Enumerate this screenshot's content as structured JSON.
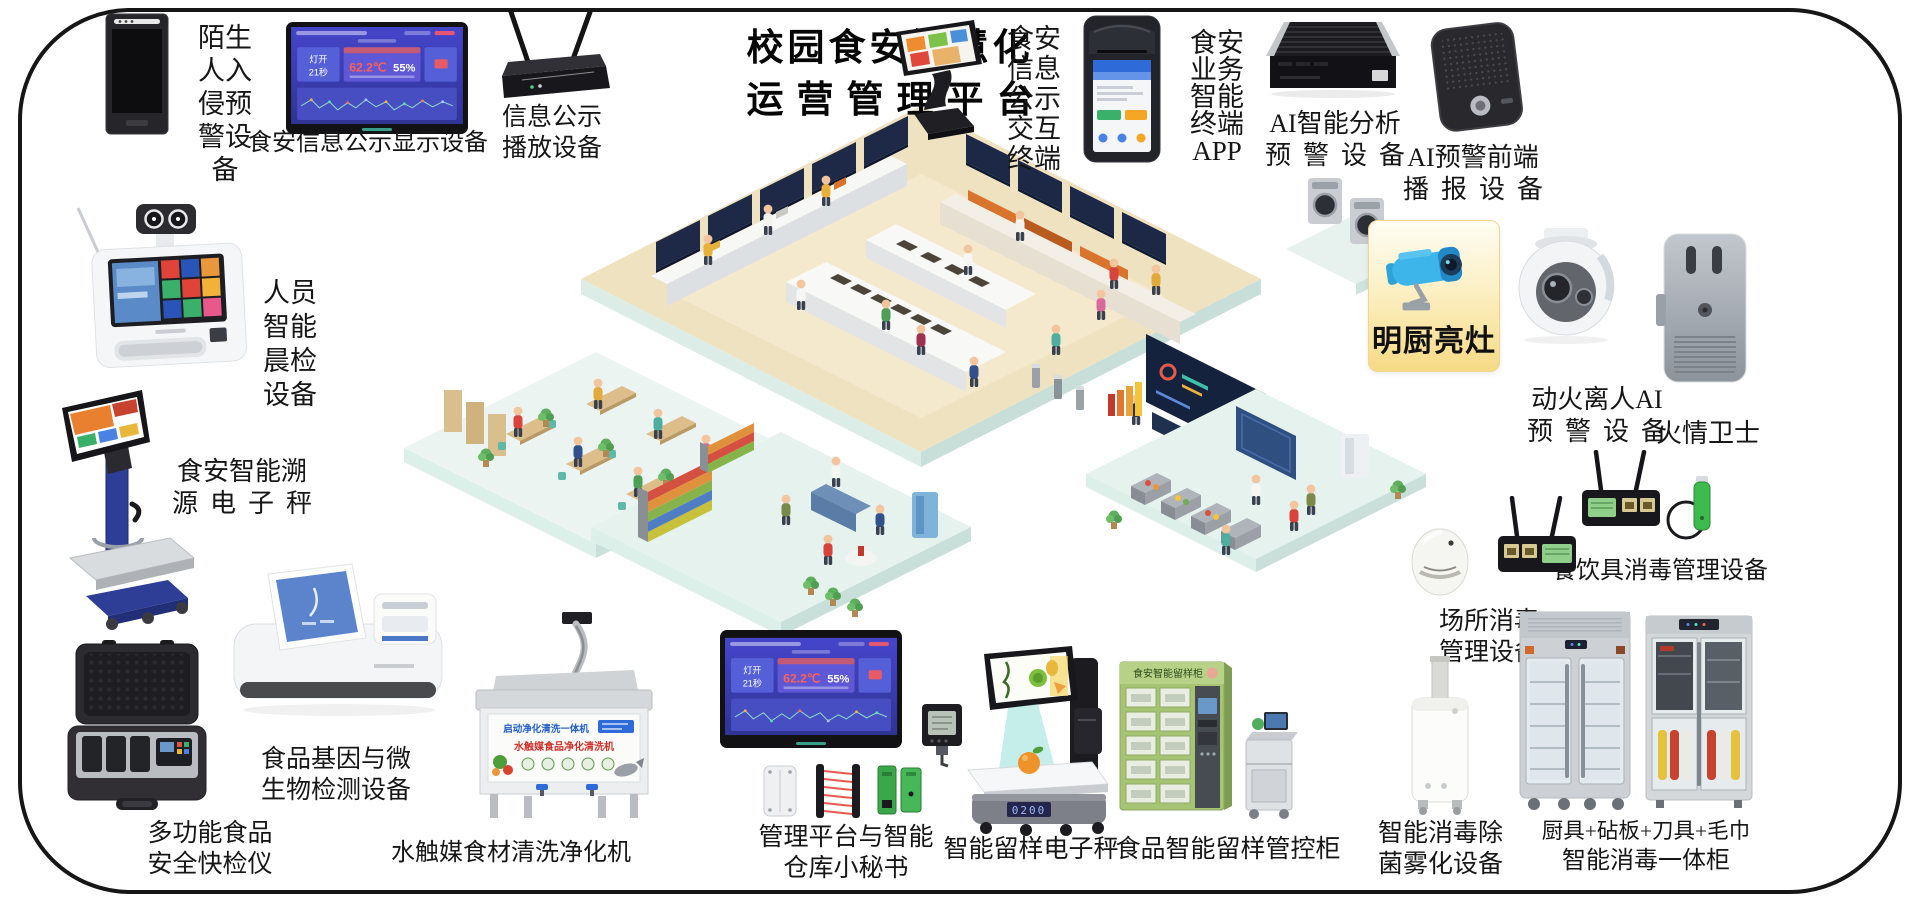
{
  "page": {
    "title_lines": [
      "校园食安智慧化",
      "运营管理平台"
    ]
  },
  "dashboard": {
    "status_line1": "灯开",
    "status_line2": "21秒",
    "temperature": "62.2℃",
    "humidity": "55%"
  },
  "devices": {
    "stranger_alarm": {
      "label_lines": [
        "陌生",
        "人入",
        "侵预",
        "警设",
        "备"
      ]
    },
    "info_display": {
      "label": "食安信息公示显示设备"
    },
    "info_player": {
      "label_lines": [
        "信息公示",
        "播放设备"
      ]
    },
    "interactive_terminal": {
      "label_lines": [
        "食安",
        "信息",
        "公示",
        "交互",
        "终端"
      ]
    },
    "business_app": {
      "label_lines": [
        "食安",
        "业务",
        "智能",
        "终端",
        "APP"
      ]
    },
    "ai_analysis": {
      "label_lines": [
        "AI智能分析",
        "预警设备"
      ]
    },
    "ai_broadcast": {
      "label_lines": [
        "AI预警前端",
        "播报设备"
      ]
    },
    "bright_kitchen": {
      "label": "明厨亮灶",
      "icon": "cctv-camera-icon"
    },
    "fire_leave_ai": {
      "label_lines": [
        "动火离人AI",
        "预警设备"
      ]
    },
    "fire_guard": {
      "label": "火情卫士"
    },
    "tableware_disinfection": {
      "label": "餐饮具消毒管理设备"
    },
    "site_disinfection": {
      "label_lines": [
        "场所消毒",
        "管理设备"
      ]
    },
    "fog_sterilizer": {
      "label_lines": [
        "智能消毒除",
        "菌雾化设备"
      ]
    },
    "utensil_cabinet": {
      "label_lines": [
        "厨具+砧板+刀具+毛巾",
        "智能消毒一体柜"
      ]
    },
    "sample_cabinet": {
      "label": "食品智能留样管控柜",
      "banner": "食安智能留样柜"
    },
    "sample_scale": {
      "label": "智能留样电子秤",
      "display_value": "0200"
    },
    "mgmt_platform": {
      "label_lines": [
        "管理平台与智能",
        "仓库小秘书"
      ]
    },
    "washer": {
      "label": "水触媒食材清洗净化机",
      "banner1": "启动净化清洗一体机",
      "banner2": "水触媒食品净化清洗机"
    },
    "gene_detector": {
      "label_lines": [
        "食品基因与微",
        "生物检测设备"
      ]
    },
    "rapid_tester": {
      "label_lines": [
        "多功能食品",
        "安全快检仪"
      ]
    },
    "trace_scale": {
      "label_lines": [
        "食安智能溯",
        "源电子秤"
      ]
    },
    "morning_check": {
      "label_lines": [
        "人员",
        "智能",
        "晨检",
        "设备"
      ]
    }
  }
}
